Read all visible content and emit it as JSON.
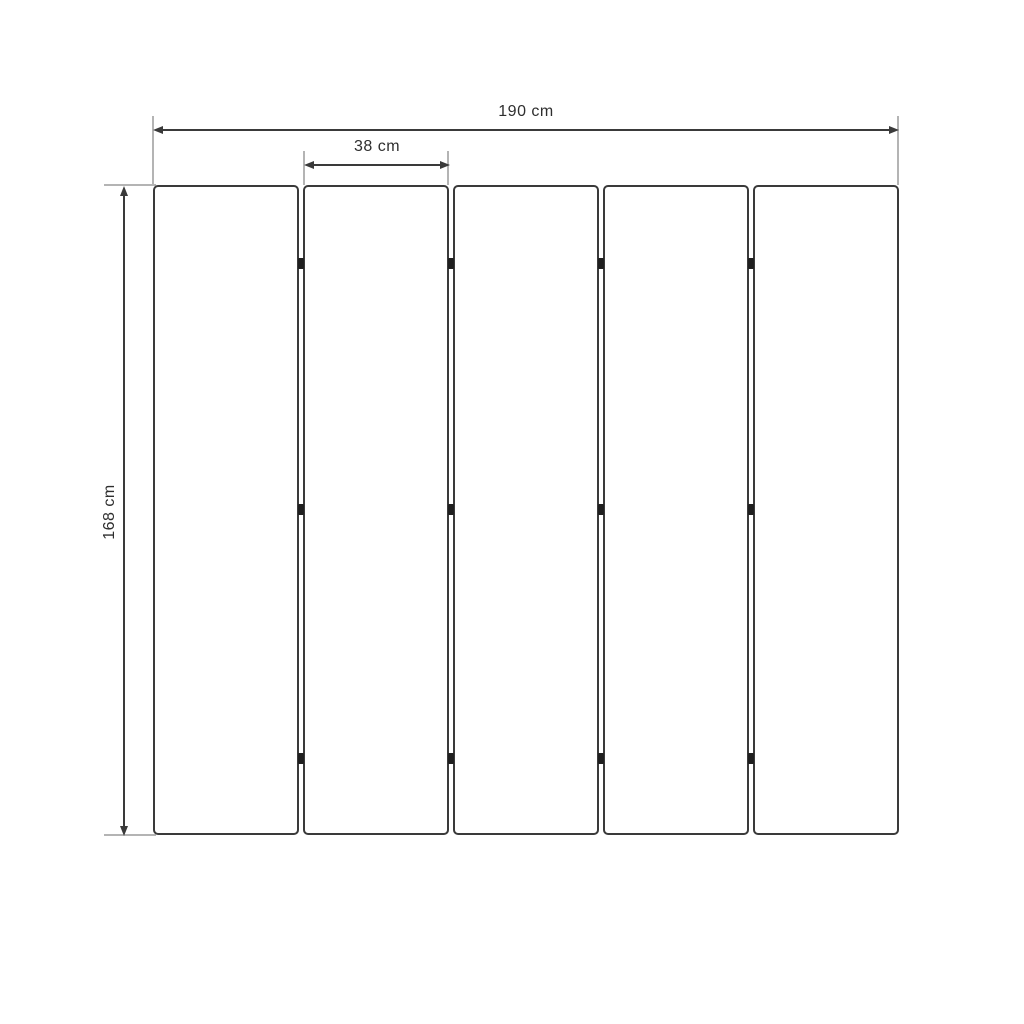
{
  "dimensions": {
    "total_width": {
      "label": "190 cm"
    },
    "panel_width": {
      "label": "38 cm"
    },
    "total_height": {
      "label": "168 cm"
    }
  },
  "structure": {
    "panel_count": 5,
    "gap_count": 4,
    "hinges_per_gap": 3
  },
  "colors": {
    "outline": "#3a3a3a",
    "extension_line": "#b4b4b4",
    "hinge": "#1f1f1f",
    "text": "#2e2e2e",
    "background": "#ffffff"
  }
}
